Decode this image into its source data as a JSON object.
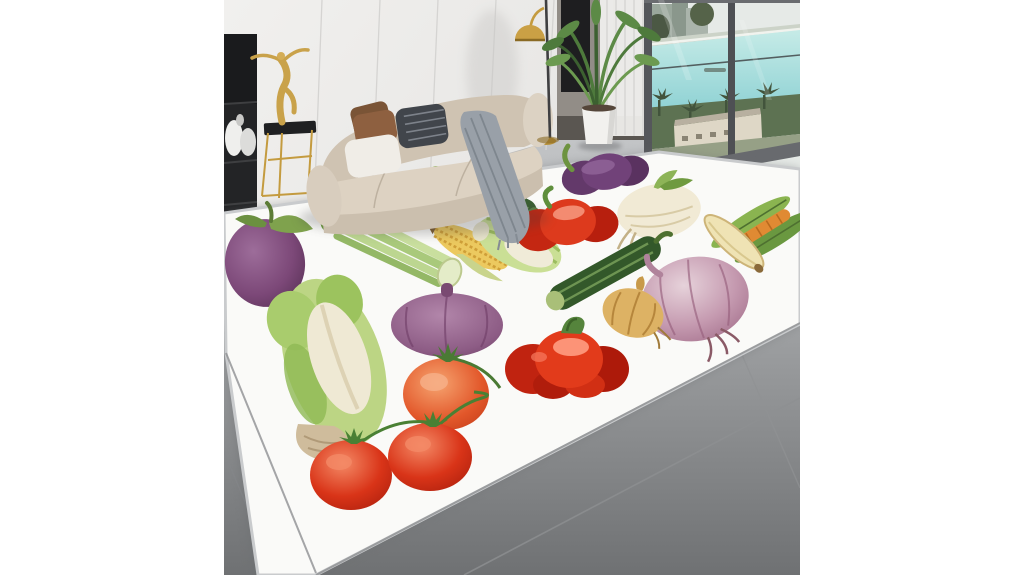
{
  "image": {
    "description": "Product photo of a white area rug printed with watercolor vegetables, staged in a modern living room with a curved beige sofa, gold floor lamp, gold dancer sculpture on a side table, dark wardrobe, potted palm and floor-to-ceiling windows overlooking turquoise water and palm trees.",
    "type": "product-photo"
  },
  "scene": {
    "room": {
      "furniture": [
        "black-shelf-unit",
        "gold-dancer-sculpture",
        "gold-side-table",
        "curved-beige-sofa",
        "throw-pillows",
        "gray-knit-throw",
        "gold-floor-lamp",
        "dark-wardrobe",
        "sheer-curtain",
        "potted-palm-plant",
        "floor-to-ceiling-window",
        "gray-tile-floor"
      ],
      "window_view": [
        "city-buildings",
        "turquoise-water",
        "balcony-rail",
        "palm-trees",
        "waterfront-building",
        "lawn"
      ]
    },
    "rug": {
      "style": "watercolor-vegetable-print-rug",
      "background": "#fafaf8",
      "vegetables": [
        "round-eggplant",
        "celery-bunch",
        "corn-cob",
        "parsley-sprigs",
        "cucumber",
        "purple-bell-pepper",
        "white-turnip",
        "small-napa-cabbage",
        "red-bell-pepper",
        "corn-husks-and-carrot",
        "pea-pod",
        "zucchini",
        "flat-purple-onion",
        "large-pink-onion",
        "yellow-onion",
        "orange-tomato",
        "large-red-bell-pepper",
        "tomato-pair-with-stems",
        "large-napa-cabbage"
      ]
    },
    "palette": {
      "margin": "#ffffff",
      "wall": "#ecebe9",
      "wardrobe": "#928d87",
      "floor_light": "#c2c4c6",
      "floor_dark": "#717375",
      "rug_white": "#fafaf8",
      "sofa_beige": "#d6cbbc",
      "gold": "#c49b3f",
      "water": "#a5dedd",
      "tomato_red": "#d93418",
      "pepper_red": "#e23b1b",
      "eggplant_purple": "#7c4878",
      "onion_pink": "#c59ab0",
      "leaf_green": "#8fb954"
    }
  }
}
